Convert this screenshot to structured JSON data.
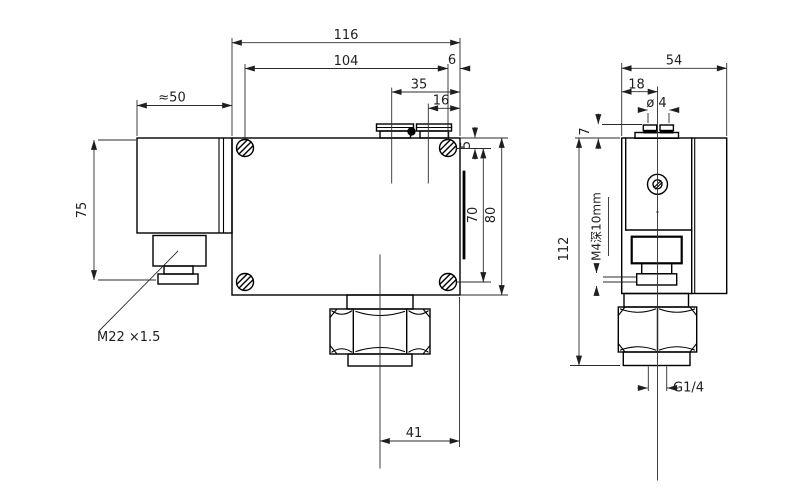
{
  "front_view": {
    "width_total": "116",
    "screw_span": "104",
    "screw_edge_offset": "6",
    "terminal_pos_a": "35",
    "terminal_pos_b": "16",
    "connector_width": "≈50",
    "connector_height": "75",
    "screw_top_offset": "5",
    "screw_span_vertical": "70",
    "height_total": "80",
    "port_to_edge": "41",
    "cable_gland_thread": "M22 ×1.5"
  },
  "side_view": {
    "depth_total": "54",
    "screw_center_offset": "18",
    "terminal_screw_dia": "ø 4",
    "terminal_head_height": "7",
    "height_total": "112",
    "mounting_thread_note": "M4深10mm",
    "pressure_port_thread": "G1/4"
  },
  "colors": {
    "line": "#000000",
    "dimension": "#2b2b2b",
    "background": "#ffffff"
  }
}
